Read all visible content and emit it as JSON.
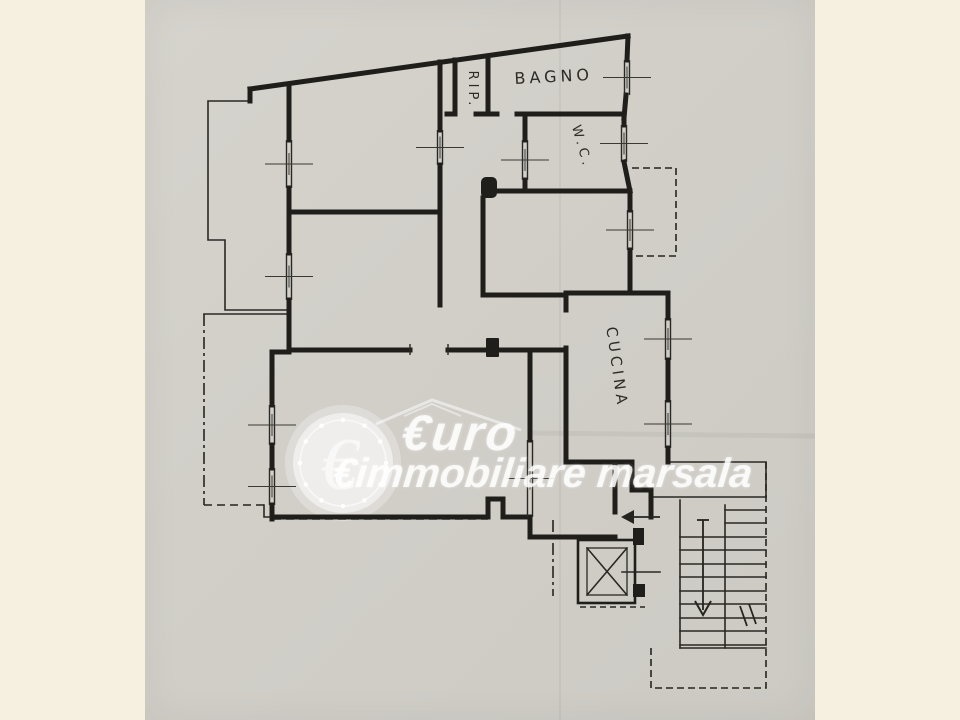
{
  "canvas": {
    "width": 960,
    "height": 720,
    "margin_color": "#f6f0e1",
    "paper_color": "#d2cfc9",
    "ink_color": "#201e1a",
    "paper_left": 145,
    "paper_width": 670
  },
  "watermark": {
    "line1": "€uro",
    "line2": "€immobiliare marsala",
    "coin_symbol": "€",
    "coin": {
      "cx": 343,
      "cy": 463,
      "r": 50,
      "ring_r": 43,
      "halo_r": 58,
      "dots": 12,
      "dot_r": 2.3
    },
    "house_roof": [
      [
        376,
        424
      ],
      [
        432,
        400
      ],
      [
        521,
        430
      ]
    ],
    "house_ridge": [
      [
        404,
        416
      ],
      [
        432,
        404
      ],
      [
        461,
        416
      ]
    ],
    "white": "rgba(255,255,255,0.8)"
  },
  "rooms": [
    {
      "id": "rip",
      "label": "RIP.",
      "x": 469,
      "y": 90,
      "rotate": 90,
      "size": 13,
      "spacing": 1
    },
    {
      "id": "bagno",
      "label": "BAGNO",
      "x": 554,
      "y": 82,
      "rotate": -3,
      "size": 16,
      "spacing": 5
    },
    {
      "id": "wc",
      "label": "W.C.",
      "x": 578,
      "y": 148,
      "rotate": 74,
      "size": 13,
      "spacing": 2
    },
    {
      "id": "cucina",
      "label": "CUCINA",
      "x": 612,
      "y": 368,
      "rotate": 82,
      "size": 15,
      "spacing": 6
    }
  ],
  "plan": {
    "walls_thick": [
      [
        [
          250,
          89
        ],
        [
          628,
          36
        ]
      ],
      [
        [
          250,
          89
        ],
        [
          250,
          101
        ]
      ],
      [
        [
          289,
          84
        ],
        [
          289,
          140
        ]
      ],
      [
        [
          289,
          188
        ],
        [
          289,
          253
        ]
      ],
      [
        [
          289,
          300
        ],
        [
          289,
          352
        ]
      ],
      [
        [
          272,
          352
        ],
        [
          289,
          352
        ]
      ],
      [
        [
          289,
          350
        ],
        [
          410,
          350
        ]
      ],
      [
        [
          448,
          350
        ],
        [
          566,
          350
        ]
      ],
      [
        [
          272,
          352
        ],
        [
          272,
          405
        ]
      ],
      [
        [
          272,
          445
        ],
        [
          272,
          468
        ]
      ],
      [
        [
          272,
          505
        ],
        [
          272,
          519
        ]
      ],
      [
        [
          272,
          517
        ],
        [
          488,
          517
        ]
      ],
      [
        [
          488,
          517
        ],
        [
          488,
          499
        ],
        [
          503,
          499
        ],
        [
          503,
          517
        ]
      ],
      [
        [
          503,
          517
        ],
        [
          530,
          517
        ]
      ],
      [
        [
          530,
          517
        ],
        [
          530,
          537
        ]
      ],
      [
        [
          530,
          537
        ],
        [
          615,
          537
        ]
      ],
      [
        [
          615,
          462
        ],
        [
          615,
          512
        ]
      ],
      [
        [
          566,
          462
        ],
        [
          632,
          462
        ]
      ],
      [
        [
          632,
          462
        ],
        [
          632,
          490
        ]
      ],
      [
        [
          632,
          490
        ],
        [
          651,
          490
        ]
      ],
      [
        [
          651,
          490
        ],
        [
          651,
          517
        ]
      ],
      [
        [
          289,
          212
        ],
        [
          440,
          212
        ]
      ],
      [
        [
          440,
          62
        ],
        [
          440,
          130
        ]
      ],
      [
        [
          440,
          165
        ],
        [
          440,
          305
        ]
      ],
      [
        [
          455,
          60
        ],
        [
          455,
          114
        ]
      ],
      [
        [
          488,
          57
        ],
        [
          488,
          114
        ]
      ],
      [
        [
          447,
          114
        ],
        [
          455,
          114
        ]
      ],
      [
        [
          476,
          114
        ],
        [
          497,
          114
        ]
      ],
      [
        [
          517,
          114
        ],
        [
          624,
          114
        ]
      ],
      [
        [
          525,
          114
        ],
        [
          525,
          140
        ]
      ],
      [
        [
          525,
          180
        ],
        [
          525,
          191
        ]
      ],
      [
        [
          498,
          191
        ],
        [
          630,
          191
        ]
      ],
      [
        [
          483,
          198
        ],
        [
          483,
          295
        ]
      ],
      [
        [
          483,
          295
        ],
        [
          566,
          295
        ]
      ],
      [
        [
          566,
          293
        ],
        [
          668,
          293
        ]
      ],
      [
        [
          566,
          293
        ],
        [
          566,
          310
        ]
      ],
      [
        [
          566,
          348
        ],
        [
          566,
          462
        ]
      ],
      [
        [
          668,
          293
        ],
        [
          668,
          318
        ]
      ],
      [
        [
          668,
          360
        ],
        [
          668,
          400
        ]
      ],
      [
        [
          668,
          448
        ],
        [
          668,
          462
        ]
      ],
      [
        [
          630,
          191
        ],
        [
          630,
          210
        ]
      ],
      [
        [
          630,
          250
        ],
        [
          630,
          293
        ]
      ],
      [
        [
          628,
          36
        ],
        [
          627,
          60
        ]
      ],
      [
        [
          626,
          95
        ],
        [
          624,
          118
        ]
      ],
      [
        [
          624,
          118
        ],
        [
          624,
          125
        ]
      ],
      [
        [
          624,
          162
        ],
        [
          630,
          191
        ]
      ],
      [
        [
          530,
          350
        ],
        [
          530,
          440
        ]
      ]
    ],
    "jambs": [
      {
        "x": 481,
        "y": 177,
        "w": 16,
        "h": 21,
        "rx": 5
      },
      {
        "x": 486,
        "y": 338,
        "w": 13,
        "h": 19,
        "rx": 1
      },
      {
        "x": 633,
        "y": 528,
        "w": 11,
        "h": 17,
        "rx": 0
      },
      {
        "x": 633,
        "y": 584,
        "w": 12,
        "h": 13,
        "rx": 0
      }
    ],
    "door_ticks": [
      [
        [
          410,
          344
        ],
        [
          410,
          355
        ]
      ],
      [
        [
          448,
          344
        ],
        [
          448,
          355
        ]
      ]
    ],
    "walls_thin": [
      [
        [
          250,
          101
        ],
        [
          208,
          101
        ],
        [
          208,
          240
        ],
        [
          225,
          240
        ],
        [
          225,
          310
        ],
        [
          287,
          310
        ]
      ],
      [
        [
          287,
          314
        ],
        [
          204,
          314
        ]
      ],
      [
        [
          264,
          505
        ],
        [
          264,
          517
        ],
        [
          272,
          517
        ]
      ],
      [
        [
          651,
          497
        ],
        [
          766,
          497
        ]
      ],
      [
        [
          680,
          500
        ],
        [
          680,
          648
        ]
      ],
      [
        [
          725,
          505
        ],
        [
          725,
          648
        ]
      ],
      [
        [
          680,
          648
        ],
        [
          766,
          648
        ]
      ],
      [
        [
          668,
          462
        ],
        [
          766,
          462
        ],
        [
          766,
          497
        ]
      ],
      [
        [
          622,
          572
        ],
        [
          660,
          572
        ]
      ],
      [
        [
          560,
          537
        ],
        [
          578,
          537
        ]
      ]
    ],
    "dashed": [
      {
        "pts": [
          [
            273,
            519
          ],
          [
            488,
            519
          ]
        ],
        "dash": "8,5"
      },
      {
        "pts": [
          [
            632,
            168
          ],
          [
            676,
            168
          ],
          [
            676,
            256
          ],
          [
            632,
            256
          ]
        ],
        "dash": "7,4"
      },
      {
        "pts": [
          [
            766,
            462
          ],
          [
            766,
            688
          ],
          [
            651,
            688
          ],
          [
            651,
            645
          ]
        ],
        "dash": "7,4"
      },
      {
        "pts": [
          [
            580,
            607
          ],
          [
            645,
            607
          ]
        ],
        "dash": "6,4"
      },
      {
        "pts": [
          [
            553,
            520
          ],
          [
            553,
            596
          ]
        ],
        "dash": "12,4,3,4"
      },
      {
        "pts": [
          [
            204,
            314
          ],
          [
            204,
            505
          ]
        ],
        "dash": "12,4,3,4"
      },
      {
        "pts": [
          [
            204,
            505
          ],
          [
            264,
            505
          ]
        ],
        "dash": "8,5"
      }
    ],
    "windows": [
      {
        "x": 289,
        "y1": 140,
        "y2": 188
      },
      {
        "x": 289,
        "y1": 253,
        "y2": 300
      },
      {
        "x": 272,
        "y1": 405,
        "y2": 445
      },
      {
        "x": 272,
        "y1": 468,
        "y2": 505
      },
      {
        "x": 627,
        "y1": 60,
        "y2": 95
      },
      {
        "x": 624,
        "y1": 125,
        "y2": 162
      },
      {
        "x": 630,
        "y1": 210,
        "y2": 250
      },
      {
        "x": 668,
        "y1": 318,
        "y2": 360
      },
      {
        "x": 668,
        "y1": 400,
        "y2": 448
      },
      {
        "x": 530,
        "y1": 440,
        "y2": 517
      },
      {
        "x": 525,
        "y1": 140,
        "y2": 180
      },
      {
        "x": 440,
        "y1": 130,
        "y2": 165
      }
    ],
    "stairs": {
      "flights": [
        {
          "x1": 725,
          "x2": 766,
          "ys": [
            510,
            523,
            537,
            550,
            564,
            577,
            591,
            604,
            618,
            631,
            645
          ]
        },
        {
          "x1": 680,
          "x2": 725,
          "ys": [
            537,
            550,
            564,
            577,
            591,
            604,
            618,
            631,
            645
          ]
        }
      ],
      "hatch": [
        [
          [
            740,
            606
          ],
          [
            747,
            626
          ]
        ],
        [
          [
            749,
            604
          ],
          [
            756,
            624
          ]
        ]
      ]
    },
    "elevator": {
      "outer": {
        "x": 578,
        "y": 540,
        "w": 57,
        "h": 63
      },
      "inner": {
        "x": 587,
        "y": 548,
        "w": 40,
        "h": 47
      }
    },
    "arrows": {
      "entry": {
        "shaft": [
          [
            660,
            517
          ],
          [
            631,
            517
          ]
        ],
        "head": [
          [
            621,
            517
          ],
          [
            634,
            510
          ],
          [
            634,
            524
          ]
        ]
      },
      "down": {
        "shaft": [
          [
            703,
            520
          ],
          [
            703,
            610
          ]
        ],
        "tail": [
          [
            697,
            520
          ],
          [
            709,
            520
          ]
        ],
        "head": [
          [
            695,
            601
          ],
          [
            703,
            615
          ],
          [
            711,
            601
          ]
        ]
      }
    },
    "creases": [
      {
        "pts": [
          [
            560,
            0
          ],
          [
            560,
            720
          ]
        ],
        "w": 2
      },
      {
        "pts": [
          [
            530,
            433
          ],
          [
            815,
            436
          ]
        ],
        "w": 5
      }
    ]
  }
}
